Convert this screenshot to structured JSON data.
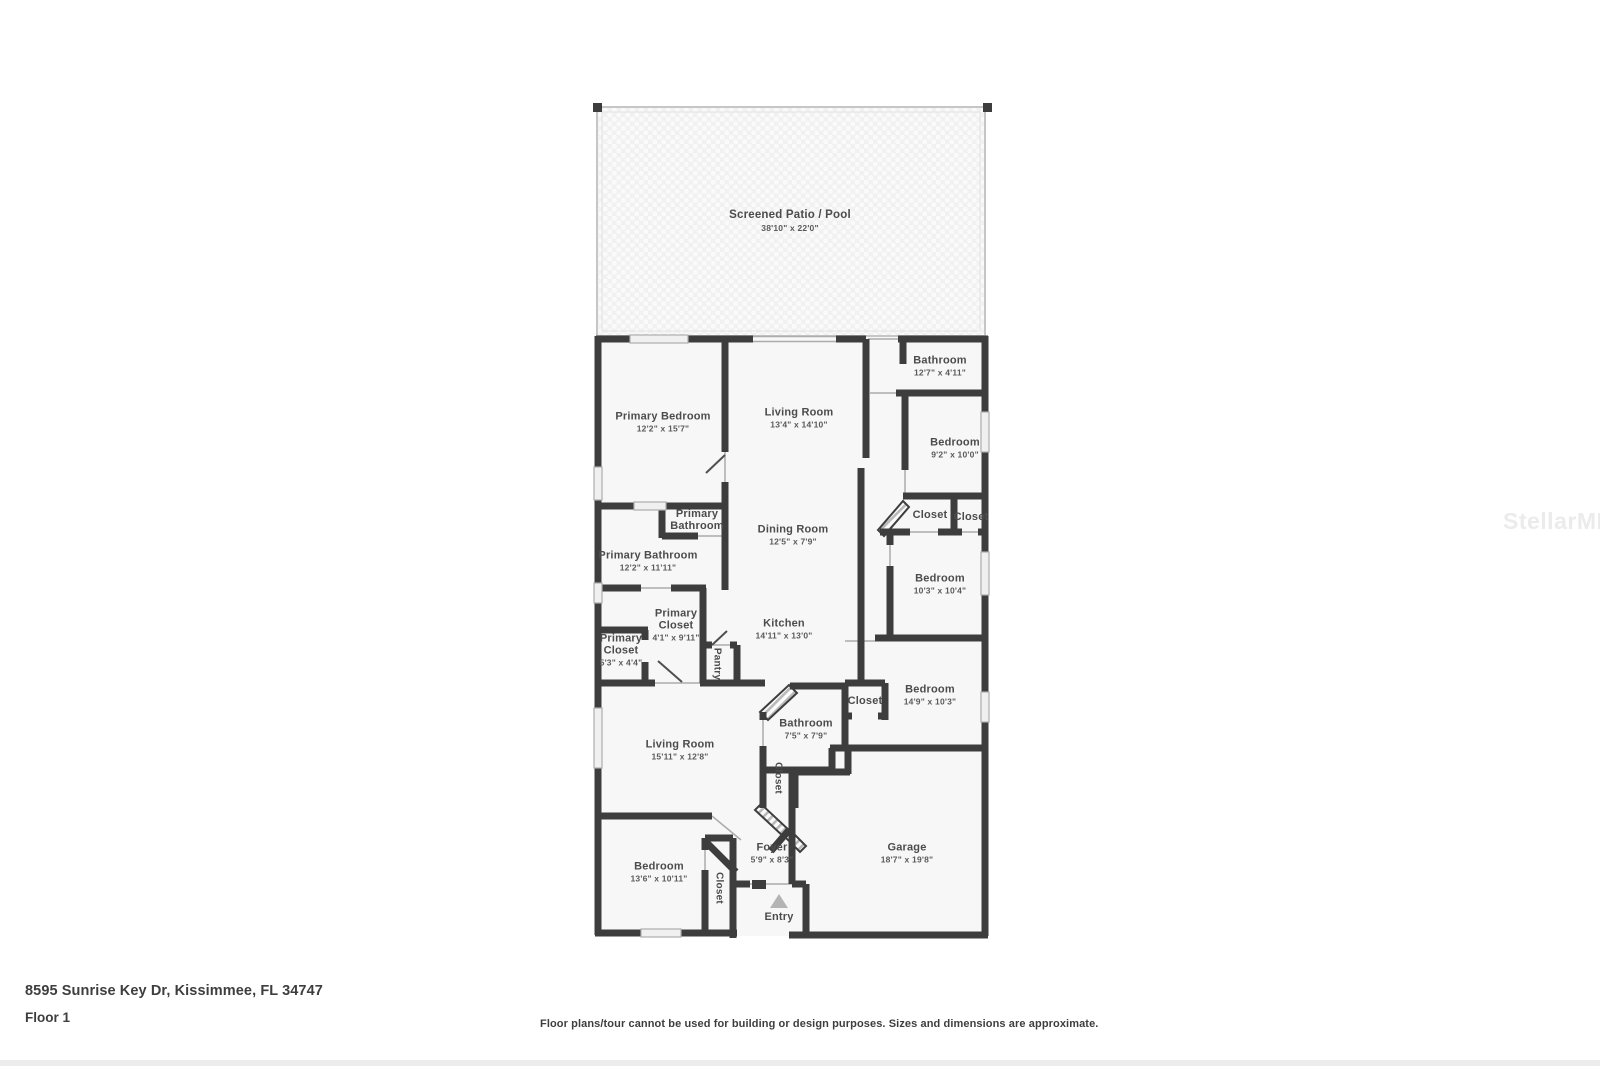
{
  "floorplan": {
    "rooms": [
      {
        "name": "Screened Patio / Pool",
        "dims": "38'10\" x 22'0\""
      },
      {
        "name": "Primary Bedroom",
        "dims": "12'2\" x 15'7\""
      },
      {
        "name": "Living Room",
        "dims": "13'4\" x 14'10\""
      },
      {
        "name": "Bathroom",
        "dims": "12'7\" x 4'11\""
      },
      {
        "name": "Bedroom",
        "dims": "9'2\" x 10'0\""
      },
      {
        "name": "Primary Bathroom",
        "dims": ""
      },
      {
        "name": "Primary Bathroom",
        "dims": "12'2\" x 11'11\""
      },
      {
        "name": "Dining Room",
        "dims": "12'5\" x 7'9\""
      },
      {
        "name": "Closet",
        "dims": ""
      },
      {
        "name": "Closet",
        "dims": ""
      },
      {
        "name": "Bedroom",
        "dims": "10'3\" x 10'4\""
      },
      {
        "name": "Primary Closet",
        "dims": "4'1\" x 9'11\""
      },
      {
        "name": "Primary Closet",
        "dims": "5'3\" x 4'4\""
      },
      {
        "name": "Kitchen",
        "dims": "14'11\" x 13'0\""
      },
      {
        "name": "Pantry",
        "dims": ""
      },
      {
        "name": "Bedroom",
        "dims": "14'9\" x 10'3\""
      },
      {
        "name": "Closet",
        "dims": ""
      },
      {
        "name": "Bathroom",
        "dims": "7'5\" x 7'9\""
      },
      {
        "name": "Living Room",
        "dims": "15'11\" x 12'8\""
      },
      {
        "name": "Closet",
        "dims": ""
      },
      {
        "name": "Bedroom",
        "dims": "13'6\" x 10'11\""
      },
      {
        "name": "Closet",
        "dims": ""
      },
      {
        "name": "Foyer",
        "dims": "5'9\" x 8'3\""
      },
      {
        "name": "Garage",
        "dims": "18'7\" x 19'8\""
      },
      {
        "name": "Entry",
        "dims": ""
      }
    ]
  },
  "footer": {
    "address": "8595 Sunrise Key Dr, Kissimmee, FL 34747",
    "floor_label": "Floor 1",
    "disclaimer": "Floor plans/tour cannot be used for building or design purposes. Sizes and dimensions are approximate."
  },
  "watermark": "StellarMLS",
  "colors": {
    "wall": "#3d3d3d",
    "floor": "#f7f7f7",
    "patio": "#f1f1f1",
    "label": "#4c4c4c",
    "entry_marker": "#b4b4b4"
  }
}
